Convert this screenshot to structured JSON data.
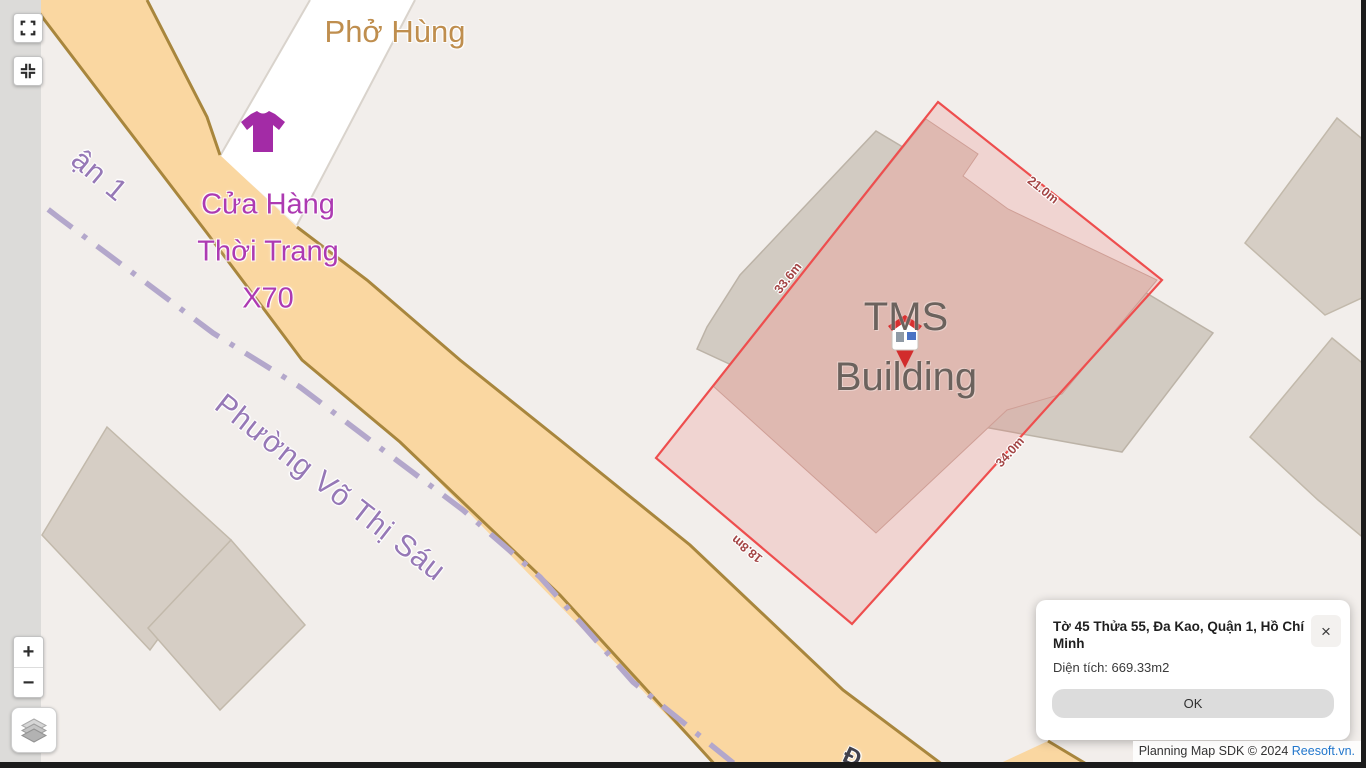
{
  "map_labels": {
    "restaurant_poi": "Phở Hùng",
    "shop_name_lines": [
      "Cửa Hàng",
      "Thời Trang",
      "X70"
    ],
    "ward_boundary": "Phường Võ Thị Sáu",
    "district_boundary_partial": "ận 1",
    "street_name_partial": "Đ",
    "building_name_lines": [
      "TMS",
      "Building"
    ]
  },
  "parcel": {
    "edge_measurements": {
      "northeast": "21.0m",
      "northwest": "33.6m",
      "southeast": "34.0m",
      "southwest": "18.8m"
    }
  },
  "map_controls": {
    "zoom_in_label": "+",
    "zoom_out_label": "−"
  },
  "info_popup": {
    "title": "Tờ 45 Thửa 55, Đa Kao, Quận 1, Hồ Chí Minh",
    "close_label": "×",
    "area_text": "Diện tích: 669.33m2",
    "ok_label": "OK"
  },
  "attribution": {
    "sdk_text": "Planning Map SDK © 2024 ",
    "link_text": "Reesoft.vn."
  },
  "colors": {
    "map_background": "#f2eeeb",
    "road_fill": "#fad7a1",
    "road_border": "#a8863d",
    "parcel_outline": "#ee4e4e",
    "parcel_fill": "rgba(236,110,105,0.20)",
    "building_footprint": "#dfb9b1",
    "boundary_dash_purple": "#b3a7cb",
    "poi_purple": "#ad3ab2",
    "label_purple": "#9678b6",
    "restaurant_label": "#bf8e4e",
    "link_blue": "#2277cc"
  }
}
